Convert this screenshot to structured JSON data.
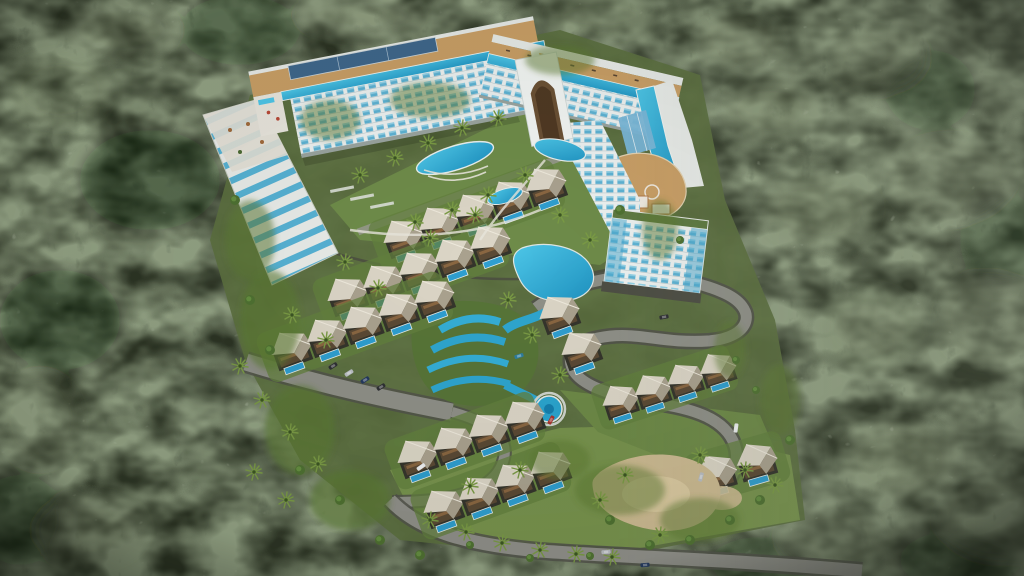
{
  "meta": {
    "title": "Aerial bird's-eye architectural rendering of a hillside resort complex surrounded by dense evergreen forest",
    "view": "3D visualization, tilt-shift style with blurred forest edges",
    "canvas": {
      "width": 1024,
      "height": 576
    }
  },
  "colors": {
    "forest_base": "#2c3424",
    "forest_mottle": "#4a5c3b",
    "forest_pale": "#859173",
    "forest_shadow": "#0f150c",
    "clearing": "#5c7040",
    "lawn": "#6f8c4a",
    "lawn_bright": "#78934e",
    "road": "#8f9088",
    "road_edge": "#52534b",
    "wall": "#4b4c42",
    "pool_light": "#4ec7e8",
    "pool_deep": "#1f93c2",
    "pool_villa": "#2f9fd0",
    "facade_white": "#edf1f0",
    "balcony_blue": "#5fb3d4",
    "balcony_glint": "#95d2e7",
    "floor_line": "#b9c6c9",
    "deck_tan": "#c99f66",
    "deck_edge": "#e3d2b2",
    "roof_light": "#dcd6c7",
    "roof_shade": "#aaa28f",
    "ridge": "#efeadd",
    "wood_brown": "#5b4a35",
    "wood_accent": "#8a6742",
    "structure_dark": "#35352c",
    "terrace_white": "#e9ece9",
    "terrace_pool": "#57b2d4",
    "sand": "#cdbb92",
    "sand_light": "#ddcda3",
    "solar_panel": "#3f678c",
    "glass_atrium": "#7ab7d8",
    "arch_brown": "#6b5135",
    "path_white": "#e8e6dc",
    "parapet": "#e7eae7",
    "palm_frond": "#7a9a45",
    "palm_core": "#3c5524",
    "bush": "#4f7132",
    "bush_light": "#699344",
    "car_white": "#eceff0",
    "car_silver": "#b9bdc2",
    "car_dark_blue": "#24395e",
    "car_red": "#a8342e",
    "car_teal": "#2e7d9e",
    "car_black": "#2e2f33",
    "slide_red": "#c0563a"
  },
  "scene": {
    "hotel": {
      "shape": "V-shaped high-rise wrapping a landscaped courtyard",
      "features": [
        "rooftop infinity pool strips",
        "timber sun deck",
        "solar panel array",
        "central arched portal",
        "glass atrium",
        "rounded timber sky deck",
        "stepped tower block"
      ],
      "floors_visible": 8
    },
    "terraced_residences": {
      "description": "cascading terrace block with plunge pools on the west slope"
    },
    "villas": {
      "total_units": 31,
      "style": "tented-canopy roof villas with private plunge pools",
      "rows": [
        {
          "name": "upper-row",
          "units": 5
        },
        {
          "name": "middle-row",
          "units": 5
        },
        {
          "name": "lower-row",
          "units": 5
        },
        {
          "name": "south-row-a",
          "units": 4
        },
        {
          "name": "south-row-b",
          "units": 4
        },
        {
          "name": "mid-singles",
          "units": 2
        },
        {
          "name": "east-row",
          "units": 4
        },
        {
          "name": "east-pair",
          "units": 2
        }
      ]
    },
    "water_features": [
      "courtyard lagoon pools",
      "winding cascade river",
      "circular pool",
      "rooftop pools",
      "villa plunge pools"
    ],
    "vehicles": [
      {
        "color": "black"
      },
      {
        "color": "silver"
      },
      {
        "color": "dark blue"
      },
      {
        "color": "black"
      },
      {
        "color": "teal"
      },
      {
        "color": "red"
      },
      {
        "color": "white"
      },
      {
        "color": "silver"
      },
      {
        "color": "dark blue"
      },
      {
        "color": "silver"
      },
      {
        "color": "black"
      },
      {
        "color": "white"
      }
    ],
    "vegetation": {
      "palm_trees": 40,
      "bright_shrubs": 20,
      "surrounding": "dense conifer and broadleaf canopy"
    },
    "ground": [
      "winding asphalt roads",
      "parking strip",
      "lawns",
      "sand garden"
    ]
  }
}
